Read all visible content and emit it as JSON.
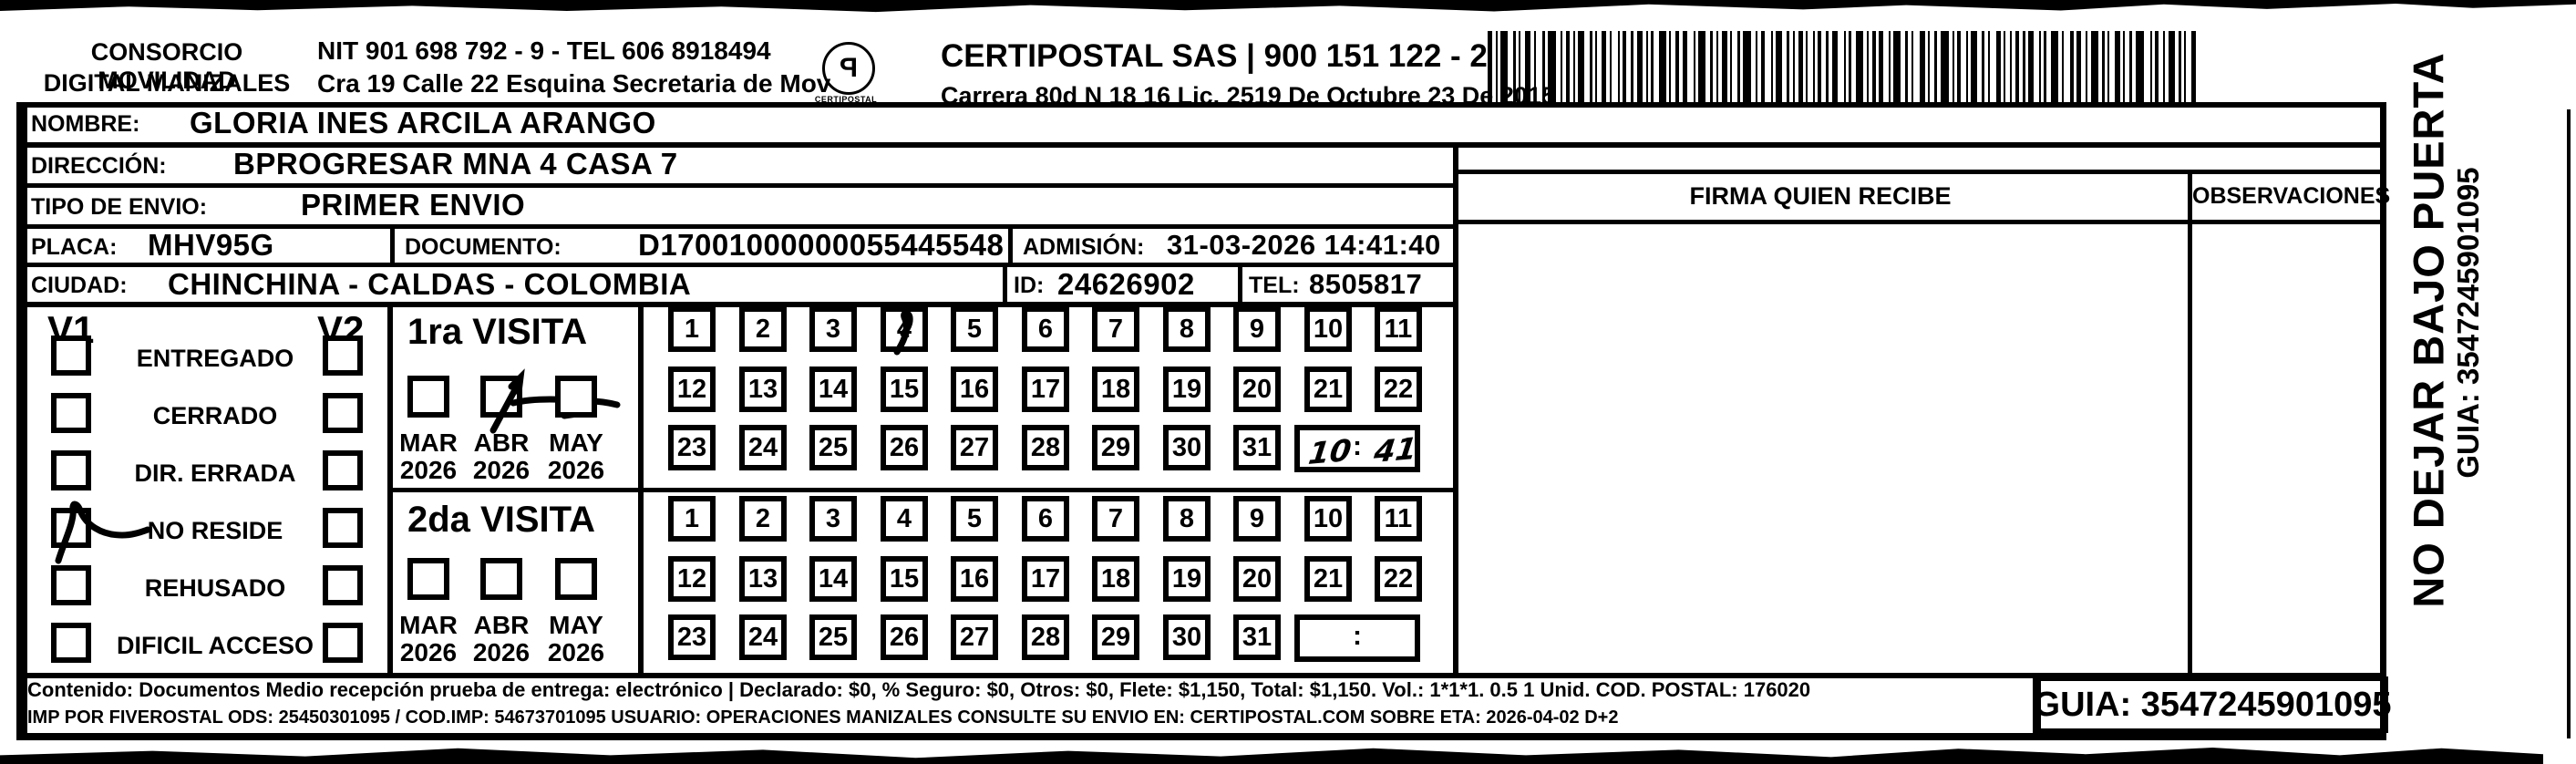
{
  "header": {
    "company_line1": "CONSORCIO MOVILIDAD",
    "company_line2": "DIGITAL MANIZALES",
    "nit_line": "NIT 901 698 792 - 9 - TEL 606 8918494",
    "address_line": "Cra 19 Calle 22 Esquina Secretaria de Mov",
    "logo_caption": "CERTIPOSTAL",
    "operator_line1": "CERTIPOSTAL SAS | 900 151 122 - 2",
    "operator_line2": "Carrera 80d N 18 16  Lic. 2519 De Octubre 23 De 2015"
  },
  "shipment": {
    "nombre_label": "NOMBRE:",
    "nombre": "GLORIA INES ARCILA ARANGO",
    "direccion_label": "DIRECCIÓN:",
    "direccion": "BPROGRESAR MNA 4 CASA 7",
    "tipo_envio_label": "TIPO DE ENVIO:",
    "tipo_envio": "PRIMER ENVIO",
    "placa_label": "PLACA:",
    "placa": "MHV95G",
    "documento_label": "DOCUMENTO:",
    "documento": "D17001000000055445548",
    "admision_label": "ADMISIÓN:",
    "admision": "31-03-2026 14:41:40",
    "ciudad_label": "CIUDAD:",
    "ciudad": "CHINCHINA - CALDAS - COLOMBIA",
    "id_label": "ID:",
    "id_value": "24626902",
    "tel_label": "TEL:",
    "tel": "8505817"
  },
  "status_panel": {
    "v1_label": "V1",
    "v2_label": "V2",
    "options": [
      "ENTREGADO",
      "CERRADO",
      "DIR. ERRADA",
      "NO RESIDE",
      "REHUSADO",
      "DIFICIL ACCESO"
    ],
    "v1_checked_option": "NO RESIDE"
  },
  "visits": {
    "months": [
      "MAR",
      "ABR",
      "MAY"
    ],
    "year": "2026",
    "day_rows": [
      [
        1,
        2,
        3,
        4,
        5,
        6,
        7,
        8,
        9,
        10,
        11
      ],
      [
        12,
        13,
        14,
        15,
        16,
        17,
        18,
        19,
        20,
        21,
        22
      ],
      [
        23,
        24,
        25,
        26,
        27,
        28,
        29,
        30,
        31
      ]
    ],
    "time_separator": ":",
    "first": {
      "title": "1ra VISITA",
      "checked_month": "ABR",
      "crossed_day": 4,
      "handwritten_time": "10:41"
    },
    "second": {
      "title": "2da VISITA",
      "checked_month": null,
      "crossed_day": null,
      "handwritten_time": null
    }
  },
  "signature": {
    "firma_header": "FIRMA QUIEN RECIBE",
    "observaciones_header": "OBSERVACIONES"
  },
  "side_note": {
    "warning": "NO DEJAR BAJO PUERTA",
    "guia": "GUIA: 3547245901095"
  },
  "footer": {
    "line1": "Contenido: Documentos Medio recepción prueba de entrega: electrónico | Declarado: $0, % Seguro: $0, Otros: $0, Flete: $1,150, Total: $1,150. Vol.: 1*1*1. 0.5 1 Unid. COD. POSTAL: 176020",
    "line2": "IMP POR FIVEROSTAL ODS: 25450301095 / COD.IMP: 54673701095 USUARIO: OPERACIONES MANIZALES CONSULTE SU ENVIO EN: CERTIPOSTAL.COM SOBRE ETA: 2026-04-02 D+2",
    "guia_box": "GUIA: 3547245901095"
  }
}
